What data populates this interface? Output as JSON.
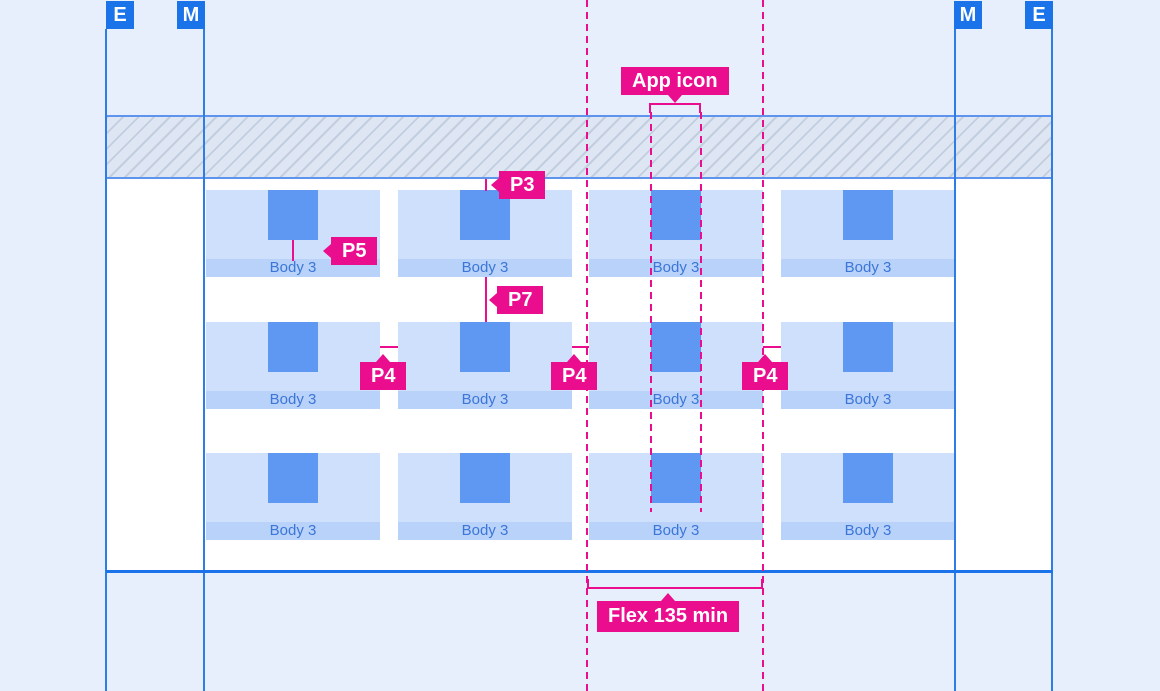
{
  "badges": [
    {
      "letter": "E"
    },
    {
      "letter": "M"
    },
    {
      "letter": "M"
    },
    {
      "letter": "E"
    }
  ],
  "labels": {
    "app_icon": "App icon",
    "p3": "P3",
    "p5": "P5",
    "p7": "P7",
    "p4_left": "P4",
    "p4_middle": "P4",
    "p4_right": "P4",
    "flex": "Flex 135 min"
  },
  "cards": [
    {
      "caption": "Body 3"
    },
    {
      "caption": "Body 3"
    },
    {
      "caption": "Body 3"
    },
    {
      "caption": "Body 3"
    },
    {
      "caption": "Body 3"
    },
    {
      "caption": "Body 3"
    },
    {
      "caption": "Body 3"
    },
    {
      "caption": "Body 3"
    },
    {
      "caption": "Body 3"
    },
    {
      "caption": "Body 3"
    },
    {
      "caption": "Body 3"
    },
    {
      "caption": "Body 3"
    }
  ],
  "colors": {
    "annotation_pink": "#ea0d8d",
    "guide_blue": "#1a73e8",
    "card_fill": "#cee0fc",
    "card_strip": "#b9d2fa",
    "icon_square": "#5f98f3",
    "caption_text": "#3b76d8",
    "background": "#e7eefc",
    "surface": "#ffffff"
  }
}
